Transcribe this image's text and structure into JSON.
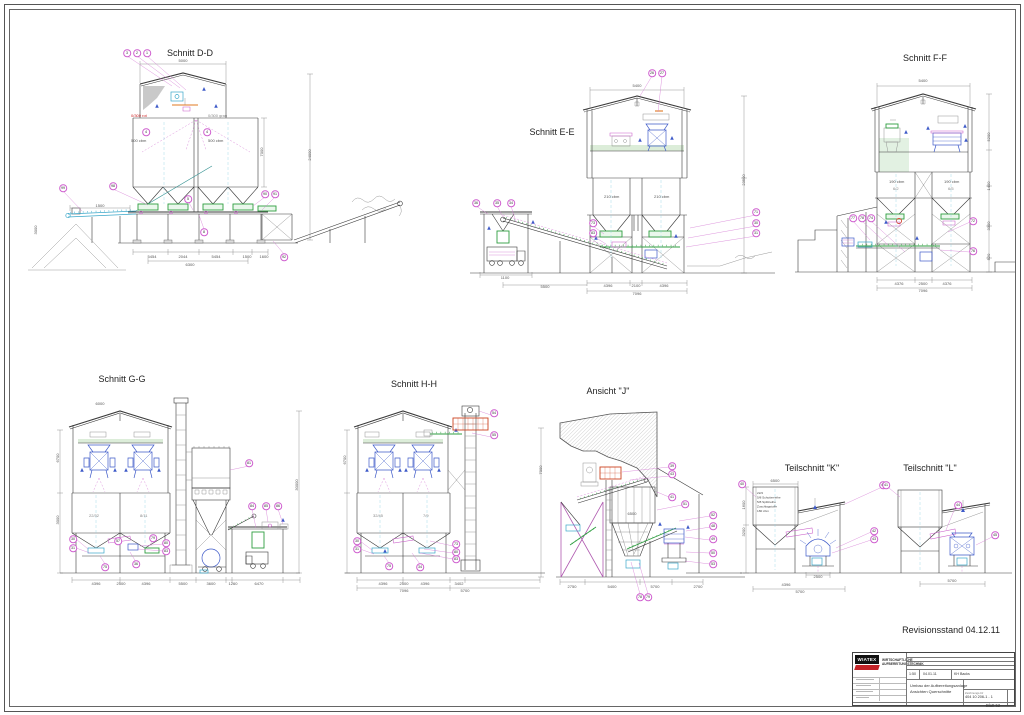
{
  "page": {
    "revision_note": "Revisionsstand 04.12.11"
  },
  "views": {
    "dd": {
      "title": "Schnitt D-D",
      "silo_left_type": "0/300 rot",
      "silo_left_vol": "500 cbm",
      "silo_right_type": "0/300 grau",
      "silo_right_vol": "500 cbm"
    },
    "ee": {
      "title": "Schnitt E-E",
      "bin_left": "210 cbm",
      "bin_right": "210 cbm"
    },
    "ff": {
      "title": "Schnitt F-F",
      "bin_left": "190 cbm",
      "bin_right": "190 cbm",
      "code_left": "6/2",
      "code_right": "6/5"
    },
    "gg": {
      "title": "Schnitt G-G",
      "code_left": "22/32",
      "code_right": "8/11"
    },
    "hh": {
      "title": "Schnitt H-H",
      "code_left": "32/45",
      "code_right": "7/9"
    },
    "j": {
      "title": "Ansicht \"J\""
    },
    "k": {
      "title": "Teilschnitt \"K\"",
      "bin_lines": [
        "22/4",
        "5/8 Schotterreihe",
        "5/8 Splittreihe",
        "Zuschlagstoffe",
        "180 cbm"
      ]
    },
    "l": {
      "title": "Teilschnitt \"L\""
    }
  },
  "title_block": {
    "logo_text": "WIATEX",
    "org_line1": "WIRTSCHAFTLICHE",
    "org_line2": "AUFBEREITUNGSTECHNIK",
    "scale": "1:50",
    "date": "04.01.11",
    "author": "KH Backs",
    "project_line1": "Umbau der Aufbereitungsanlage",
    "project_line2": "Ansichten Querschnitte",
    "drawing_no_label": "Zeichnungs-Nr",
    "drawing_no": "404 10 206-1 - 1",
    "sheet": "Blatt 52"
  },
  "colors": {
    "accent_magenta": "#cc55cc",
    "equipment_green": "#2f9e41",
    "conveyor_cyan": "#3aa7c9",
    "machine_blue": "#3f5bc9",
    "highlight_orange": "#e07820",
    "label_red": "#cc2222"
  },
  "balloons": {
    "dd": [
      {
        "x": 127,
        "y": 53,
        "n": "3"
      },
      {
        "x": 137,
        "y": 53,
        "n": "2"
      },
      {
        "x": 147,
        "y": 53,
        "n": "1"
      },
      {
        "x": 146,
        "y": 132,
        "n": "4"
      },
      {
        "x": 207,
        "y": 132,
        "n": "4"
      },
      {
        "x": 63,
        "y": 188,
        "n": "99"
      },
      {
        "x": 113,
        "y": 186,
        "n": "98"
      },
      {
        "x": 188,
        "y": 199,
        "n": "5"
      },
      {
        "x": 265,
        "y": 194,
        "n": "90"
      },
      {
        "x": 275,
        "y": 194,
        "n": "91"
      },
      {
        "x": 204,
        "y": 232,
        "n": "8"
      },
      {
        "x": 284,
        "y": 257,
        "n": "92"
      }
    ],
    "ee": [
      {
        "x": 652,
        "y": 73,
        "n": "26"
      },
      {
        "x": 662,
        "y": 73,
        "n": "27"
      },
      {
        "x": 476,
        "y": 203,
        "n": "36"
      },
      {
        "x": 497,
        "y": 203,
        "n": "35"
      },
      {
        "x": 511,
        "y": 203,
        "n": "34"
      },
      {
        "x": 756,
        "y": 212,
        "n": "71"
      },
      {
        "x": 756,
        "y": 223,
        "n": "30"
      },
      {
        "x": 756,
        "y": 233,
        "n": "31"
      },
      {
        "x": 593,
        "y": 223,
        "n": "73"
      },
      {
        "x": 593,
        "y": 233,
        "n": "83"
      }
    ],
    "ff": [
      {
        "x": 853,
        "y": 218,
        "n": "77"
      },
      {
        "x": 862,
        "y": 218,
        "n": "78"
      },
      {
        "x": 871,
        "y": 218,
        "n": "74"
      },
      {
        "x": 973,
        "y": 221,
        "n": "72"
      },
      {
        "x": 973,
        "y": 251,
        "n": "76"
      }
    ],
    "gg": [
      {
        "x": 249,
        "y": 463,
        "n": "81"
      },
      {
        "x": 252,
        "y": 506,
        "n": "84"
      },
      {
        "x": 266,
        "y": 506,
        "n": "85"
      },
      {
        "x": 278,
        "y": 506,
        "n": "86"
      },
      {
        "x": 73,
        "y": 539,
        "n": "30"
      },
      {
        "x": 73,
        "y": 548,
        "n": "31"
      },
      {
        "x": 118,
        "y": 541,
        "n": "57"
      },
      {
        "x": 153,
        "y": 538,
        "n": "79"
      },
      {
        "x": 166,
        "y": 543,
        "n": "80"
      },
      {
        "x": 166,
        "y": 551,
        "n": "83"
      },
      {
        "x": 105,
        "y": 567,
        "n": "75"
      },
      {
        "x": 136,
        "y": 564,
        "n": "36"
      }
    ],
    "hh": [
      {
        "x": 494,
        "y": 413,
        "n": "54"
      },
      {
        "x": 494,
        "y": 435,
        "n": "55"
      },
      {
        "x": 357,
        "y": 541,
        "n": "30"
      },
      {
        "x": 357,
        "y": 549,
        "n": "31"
      },
      {
        "x": 456,
        "y": 544,
        "n": "73"
      },
      {
        "x": 456,
        "y": 552,
        "n": "80"
      },
      {
        "x": 456,
        "y": 559,
        "n": "83"
      },
      {
        "x": 389,
        "y": 566,
        "n": "75"
      },
      {
        "x": 420,
        "y": 567,
        "n": "34"
      }
    ],
    "j": [
      {
        "x": 672,
        "y": 466,
        "n": "39"
      },
      {
        "x": 672,
        "y": 474,
        "n": "43"
      },
      {
        "x": 672,
        "y": 497,
        "n": "41"
      },
      {
        "x": 685,
        "y": 504,
        "n": "51"
      },
      {
        "x": 713,
        "y": 515,
        "n": "52"
      },
      {
        "x": 713,
        "y": 526,
        "n": "48"
      },
      {
        "x": 713,
        "y": 539,
        "n": "49"
      },
      {
        "x": 713,
        "y": 553,
        "n": "50"
      },
      {
        "x": 713,
        "y": 564,
        "n": "53"
      },
      {
        "x": 640,
        "y": 597,
        "n": "78"
      },
      {
        "x": 648,
        "y": 597,
        "n": "79"
      }
    ],
    "k": [
      {
        "x": 742,
        "y": 484,
        "n": "40"
      },
      {
        "x": 883,
        "y": 485,
        "n": "41"
      },
      {
        "x": 874,
        "y": 531,
        "n": "42"
      },
      {
        "x": 874,
        "y": 539,
        "n": "43"
      }
    ],
    "l": [
      {
        "x": 886,
        "y": 485,
        "n": "41"
      },
      {
        "x": 958,
        "y": 505,
        "n": "44"
      },
      {
        "x": 995,
        "y": 535,
        "n": "45"
      }
    ]
  },
  "dims": {
    "dd": [
      {
        "x": 183,
        "y": 61,
        "t": "5000"
      },
      {
        "x": 262,
        "y": 152,
        "t": "7000",
        "r": -90
      },
      {
        "x": 310,
        "y": 155,
        "t": "24000",
        "r": -90
      },
      {
        "x": 100,
        "y": 206,
        "t": "1500"
      },
      {
        "x": 36,
        "y": 230,
        "t": "3000",
        "r": -90
      },
      {
        "x": 152,
        "y": 257,
        "t": "5454"
      },
      {
        "x": 183,
        "y": 257,
        "t": "2044"
      },
      {
        "x": 216,
        "y": 257,
        "t": "5454"
      },
      {
        "x": 247,
        "y": 257,
        "t": "1500"
      },
      {
        "x": 264,
        "y": 257,
        "t": "1600"
      },
      {
        "x": 190,
        "y": 265,
        "t": "6300"
      }
    ],
    "ee": [
      {
        "x": 637,
        "y": 86,
        "t": "5400"
      },
      {
        "x": 744,
        "y": 180,
        "t": "23500",
        "r": -90
      },
      {
        "x": 545,
        "y": 287,
        "t": "5500"
      },
      {
        "x": 505,
        "y": 278,
        "t": "1100"
      },
      {
        "x": 608,
        "y": 286,
        "t": "4396"
      },
      {
        "x": 636,
        "y": 286,
        "t": "2100"
      },
      {
        "x": 664,
        "y": 286,
        "t": "4396"
      },
      {
        "x": 637,
        "y": 294,
        "t": "7096"
      }
    ],
    "ff": [
      {
        "x": 923,
        "y": 81,
        "t": "5400"
      },
      {
        "x": 989,
        "y": 137,
        "t": "5200",
        "r": -90
      },
      {
        "x": 989,
        "y": 186,
        "t": "1400",
        "r": -90
      },
      {
        "x": 989,
        "y": 226,
        "t": "3300",
        "r": -90
      },
      {
        "x": 989,
        "y": 257,
        "t": "520",
        "r": -90
      },
      {
        "x": 899,
        "y": 284,
        "t": "4376"
      },
      {
        "x": 923,
        "y": 284,
        "t": "2500"
      },
      {
        "x": 947,
        "y": 284,
        "t": "4376"
      },
      {
        "x": 923,
        "y": 291,
        "t": "7096"
      }
    ],
    "gg": [
      {
        "x": 100,
        "y": 404,
        "t": "6000"
      },
      {
        "x": 58,
        "y": 458,
        "t": "6700",
        "r": -90
      },
      {
        "x": 58,
        "y": 520,
        "t": "3000",
        "r": -90
      },
      {
        "x": 297,
        "y": 485,
        "t": "30000",
        "r": -90
      },
      {
        "x": 96,
        "y": 584,
        "t": "4396"
      },
      {
        "x": 121,
        "y": 584,
        "t": "2500"
      },
      {
        "x": 146,
        "y": 584,
        "t": "4396"
      },
      {
        "x": 183,
        "y": 584,
        "t": "5500"
      },
      {
        "x": 211,
        "y": 584,
        "t": "3600"
      },
      {
        "x": 233,
        "y": 584,
        "t": "1260"
      },
      {
        "x": 259,
        "y": 584,
        "t": "6470"
      }
    ],
    "hh": [
      {
        "x": 345,
        "y": 460,
        "t": "6700",
        "r": -90
      },
      {
        "x": 383,
        "y": 584,
        "t": "4396"
      },
      {
        "x": 404,
        "y": 584,
        "t": "2500"
      },
      {
        "x": 425,
        "y": 584,
        "t": "4396"
      },
      {
        "x": 459,
        "y": 584,
        "t": "3402"
      },
      {
        "x": 404,
        "y": 591,
        "t": "7096"
      },
      {
        "x": 465,
        "y": 591,
        "t": "5700"
      }
    ],
    "j": [
      {
        "x": 541,
        "y": 470,
        "t": "7000",
        "r": -90
      },
      {
        "x": 632,
        "y": 514,
        "t": "6500"
      },
      {
        "x": 572,
        "y": 587,
        "t": "2750"
      },
      {
        "x": 612,
        "y": 587,
        "t": "5400"
      },
      {
        "x": 655,
        "y": 587,
        "t": "5700"
      },
      {
        "x": 698,
        "y": 587,
        "t": "2700"
      }
    ],
    "k": [
      {
        "x": 775,
        "y": 481,
        "t": "6500"
      },
      {
        "x": 744,
        "y": 505,
        "t": "1600",
        "r": -90
      },
      {
        "x": 744,
        "y": 532,
        "t": "3200",
        "r": -90
      },
      {
        "x": 818,
        "y": 577,
        "t": "2500"
      },
      {
        "x": 786,
        "y": 585,
        "t": "4396"
      },
      {
        "x": 800,
        "y": 592,
        "t": "5700"
      }
    ],
    "l": [
      {
        "x": 952,
        "y": 581,
        "t": "5700"
      }
    ]
  }
}
